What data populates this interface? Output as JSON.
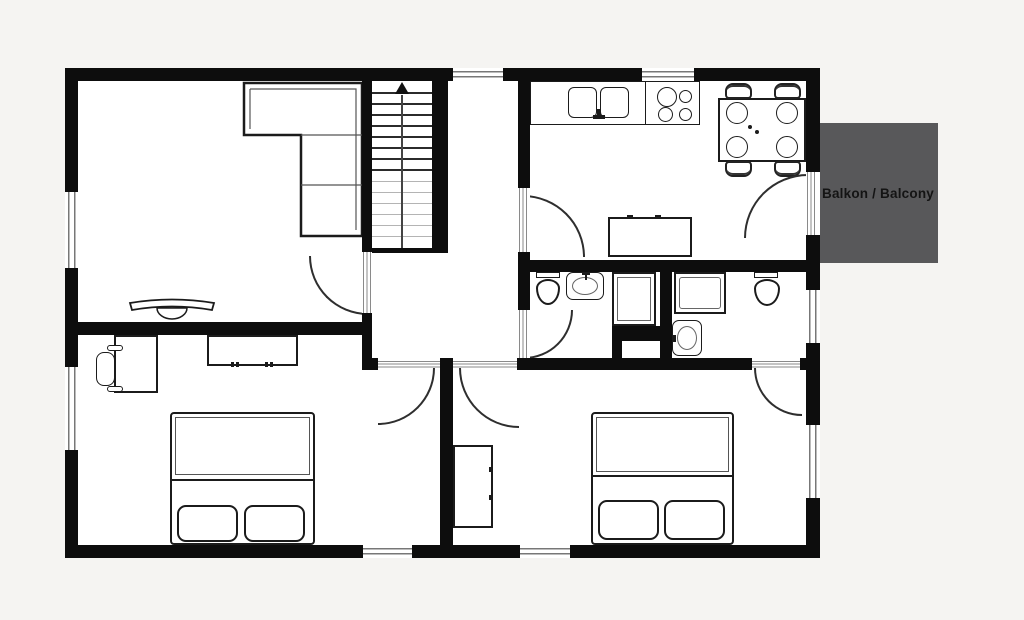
{
  "balcony": {
    "label": "Balkon / Balcony"
  },
  "colors": {
    "page_background": "#f5f4f2",
    "floor": "#ffffff",
    "wall": "#0d0d0d",
    "balcony_fill": "#58585a",
    "balcony_text": "#141414",
    "furniture_outline": "#1b1b1b",
    "window_lines": "#777777"
  },
  "plan": {
    "type": "apartment-floor-plan",
    "stairs": {
      "direction": "up"
    },
    "rooms": [
      "living-room",
      "hallway",
      "kitchen-dining",
      "shower-wc",
      "ensuite-bathroom",
      "bedroom-left",
      "bedroom-right",
      "balcony"
    ],
    "furniture": {
      "living_room": [
        "corner-sofa",
        "tv-console"
      ],
      "kitchen_dining": [
        "kitchen-counter",
        "double-sink",
        "cooktop-4-burners",
        "sideboard",
        "dining-table",
        "dining-chairs-x4",
        "plates-x4"
      ],
      "shower_wc": [
        "toilet",
        "washbasin",
        "shower"
      ],
      "ensuite_bathroom": [
        "shower-tub",
        "washbasin",
        "toilet"
      ],
      "bedroom_left": [
        "double-bed",
        "pillows-x2",
        "desk",
        "desk-chair",
        "dresser"
      ],
      "bedroom_right": [
        "double-bed",
        "pillows-x2",
        "wardrobe"
      ]
    }
  }
}
